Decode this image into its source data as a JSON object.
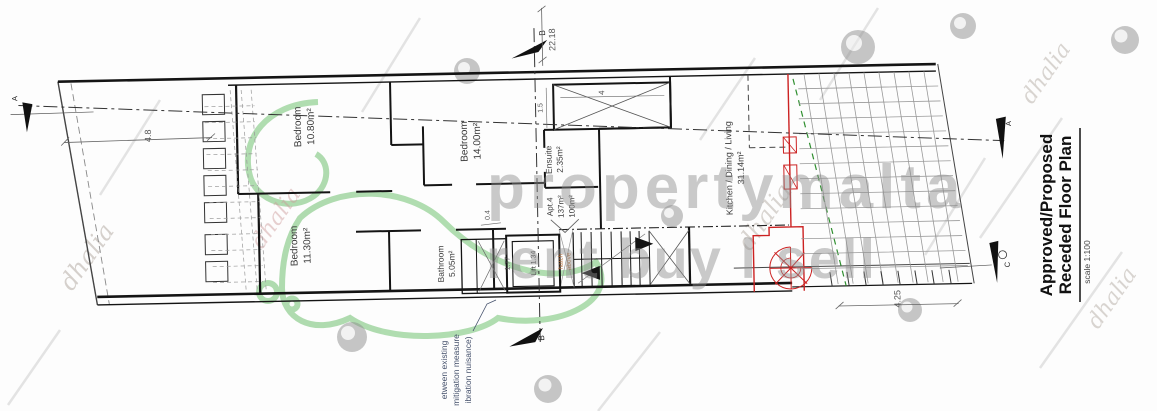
{
  "drawing": {
    "title": {
      "line1": "Approved/Proposed",
      "line2": "Receded Floor Plan",
      "scale": "scale 1:100"
    },
    "rooms": {
      "bedroom1": {
        "name": "Bedroom",
        "area": "10.80m²"
      },
      "bedroom2": {
        "name": "Bedroom",
        "area": "14.00m²"
      },
      "ensuite": {
        "name": "Ensuite",
        "area": "2.35m²"
      },
      "bedroom3": {
        "name": "Bedroom",
        "area": "11.30m²"
      },
      "bathroom": {
        "name": "Bathroom",
        "area": "5.05m²"
      },
      "living": {
        "name": "Kitchen / Dining / Living",
        "area": "31.14m²"
      },
      "apartment": {
        "name": "Apt.4",
        "gross_area": "137m²",
        "net_area": "100m²"
      },
      "lift": {
        "label": "Lift 1.34"
      },
      "stair_note": {
        "line1": "hatch",
        "line2": "above"
      }
    },
    "dimensions": {
      "overall_length": "22.18",
      "front": "4.8",
      "terrace": "4.25",
      "shaft_length": "4",
      "shaft_width": "1.5",
      "lift_width": "1.77",
      "wall": "0.4"
    },
    "sections": {
      "top": "B",
      "bottom": "B",
      "left": "A",
      "right_upper": "A",
      "right_lower": "C"
    },
    "note": {
      "line1": "etween existing",
      "line2": "mitigation measure",
      "line3": "ibration nuisance)"
    },
    "watermark": {
      "brand": "propertymalta",
      "tagline": "rent buy l sell",
      "script": "dhalia"
    },
    "colors": {
      "red": "#cc2222",
      "green": "#8fce8f",
      "green_dash": "#2f8f2f",
      "watermark": "#8c8c8c",
      "note_blue": "#44506b",
      "orange": "#b5703d"
    }
  }
}
